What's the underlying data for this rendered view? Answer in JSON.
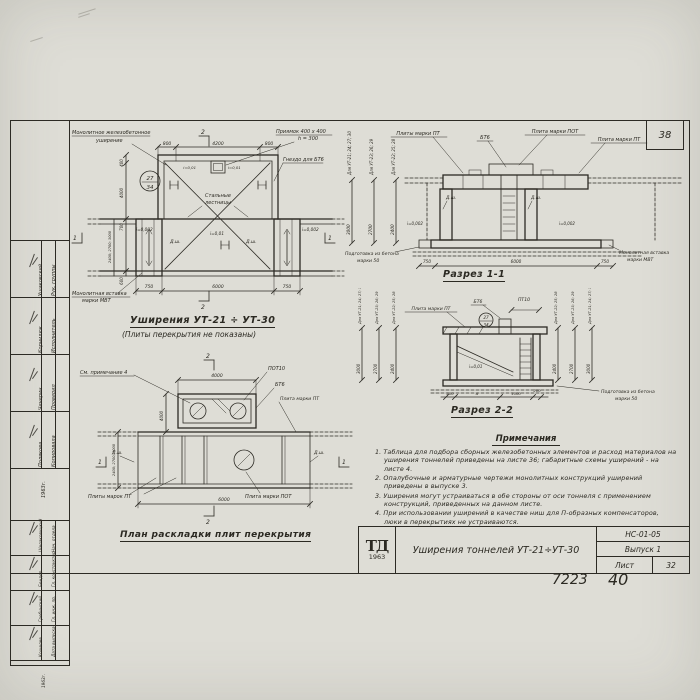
{
  "frame": {
    "corner_number": "38",
    "handwritten_left": "7223",
    "handwritten_right": "40"
  },
  "stamp": {
    "group1": [
      {
        "role": "Рук. группы",
        "name": "Ушаковский"
      },
      {
        "role": "Исполнитель",
        "name": "Корнилюк"
      },
      {
        "role": "Проверил",
        "name": "Чичерин"
      },
      {
        "role": "Копировала",
        "name": "Полякова"
      }
    ],
    "group1_year": "1963г.",
    "group2": [
      {
        "role": "Нач. отдела",
        "name": "Шелаковицкий"
      },
      {
        "role": "Гл. конструктор",
        "name": "Бендер"
      },
      {
        "role": "Гл. инж. пр.",
        "name": "Гребинский"
      },
      {
        "role": "Дата выпуска",
        "name": "Кошелев"
      }
    ],
    "group2_year": "1963г."
  },
  "drawing_plan": {
    "title": "Уширения УТ-21 ÷ УТ-30",
    "subtitle": "(Плиты перекрытия не показаны)",
    "label_monolithic_1": "Монолитное железобетонное",
    "label_monolithic_2": "уширение",
    "label_pit_1": "Приямок 400 x 400",
    "label_pit_2": "h = 300",
    "label_socket": "Гнездо для БТ6",
    "label_ladders_1": "Стальные",
    "label_ladders_2": "лестницы",
    "label_insert_1": "Монолитная вставка",
    "label_insert_2": "марки МВТ",
    "callout_num": "27",
    "callout_sheet": "34",
    "slope_pit_left": "i=0,01",
    "slope_pit_right": "i=0,01",
    "slope_mid": "i=0,01",
    "slope_edge_left": "i=0,002",
    "slope_edge_right": "i=0,002",
    "dsh_left": "Д.ш.",
    "dsh_right": "Д.ш.",
    "marker_top": "2",
    "marker_bottom": "2",
    "marker_left": "1",
    "marker_right": "1",
    "dim_top": [
      "800",
      "4200",
      "800"
    ],
    "dim_bottom": [
      "750",
      "6000",
      "750"
    ],
    "dim_left": [
      "400",
      "4000",
      "700",
      "2400; 2700; 3000",
      "600"
    ]
  },
  "section11": {
    "title": "Разрез 1-1",
    "label_plates_left": "Плиты марки ПТ",
    "label_bt6": "БТ6",
    "label_pot": "Плита марки ПОТ",
    "label_pt": "Плита марки ПТ",
    "label_prep_1": "Подготовка из бетона",
    "label_prep_2": "марки 50",
    "label_insert_1": "Монолитная вставка",
    "label_insert_2": "марки МВТ",
    "dsh_left": "Д.ш.",
    "dsh_right": "Д.ш.",
    "slope_left": "i=0,002",
    "slope_right": "i=0,002",
    "dim_cols": [
      {
        "label": "Для УТ-21; 24; 27; 30",
        "value": "3000"
      },
      {
        "label": "Для УТ-23; 26; 29",
        "value": "2700"
      },
      {
        "label": "Для УТ-22; 25; 28",
        "value": "2400"
      }
    ],
    "dim_bottom": [
      "750",
      "6000",
      "750"
    ]
  },
  "section22": {
    "title": "Разрез 2-2",
    "label_pt": "Плита марки ПТ",
    "label_bt6": "БТ6",
    "label_pt10": "ПТ10",
    "callout_num": "27",
    "callout_sheet": "34",
    "slope": "i=0,01",
    "label_prep_1": "Подготовка из бетона",
    "label_prep_2": "марки 50",
    "dim_cols_left": [
      {
        "label": "Для УТ-21; 24; 27; 30",
        "value": "3000"
      },
      {
        "label": "Для УТ-23; 26; 29",
        "value": "2700"
      },
      {
        "label": "Для УТ-22; 25; 28",
        "value": "2400"
      }
    ],
    "dim_cols_right": [
      {
        "label": "Для УТ-22; 25; 28",
        "value": "2400"
      },
      {
        "label": "Для УТ-23; 26; 29",
        "value": "2700"
      },
      {
        "label": "Для УТ-21; 24; 27; 30",
        "value": "3000"
      }
    ],
    "dim_bottom": [
      "200",
      "А",
      "1000",
      "200"
    ]
  },
  "plan_slabs": {
    "title": "План раскладки плит перекрытия",
    "label_note": "См. примечание 4",
    "label_pot10": "ПОТ10",
    "label_bt6": "БТ6",
    "label_pt": "Плита марки ПТ",
    "label_pts": "Плиты марок ПТ",
    "label_pot": "Плита марки ПОТ",
    "dsh_left": "Д.ш.",
    "dsh_right": "Д.ш.",
    "marker_top": "2",
    "marker_bottom": "2",
    "marker_left": "1",
    "marker_right": "1",
    "dim_top": "4000",
    "dim_bottom": "6000",
    "dim_left_upper": "4000",
    "dim_left_lower": "2400; 2700; 3000"
  },
  "notes": {
    "title": "Примечания",
    "items": [
      "1. Таблица для подбора сборных железобетонных элементов и расход материалов на уширения тоннелей приведены на листе 36; габаритные схемы уширений - на листе 4.",
      "2. Опалубочные и арматурные чертежи монолитных конструкций уширений приведены в выпуске 3.",
      "3. Уширения могут устраиваться в обе стороны от оси тоннеля с применением конструкций, приведенных на данном листе.",
      "4. При использовании уширений в качестве ниш для П-образных компенсаторов, люки в перекрытиях не устраиваются."
    ]
  },
  "titleblock": {
    "logo_top": "ТД",
    "logo_year": "1963",
    "title": "Уширения тоннелей УТ-21÷УТ-30",
    "code": "НС-01-05",
    "issue": "Выпуск 1",
    "sheet_label": "Лист",
    "sheet_number": "32"
  }
}
